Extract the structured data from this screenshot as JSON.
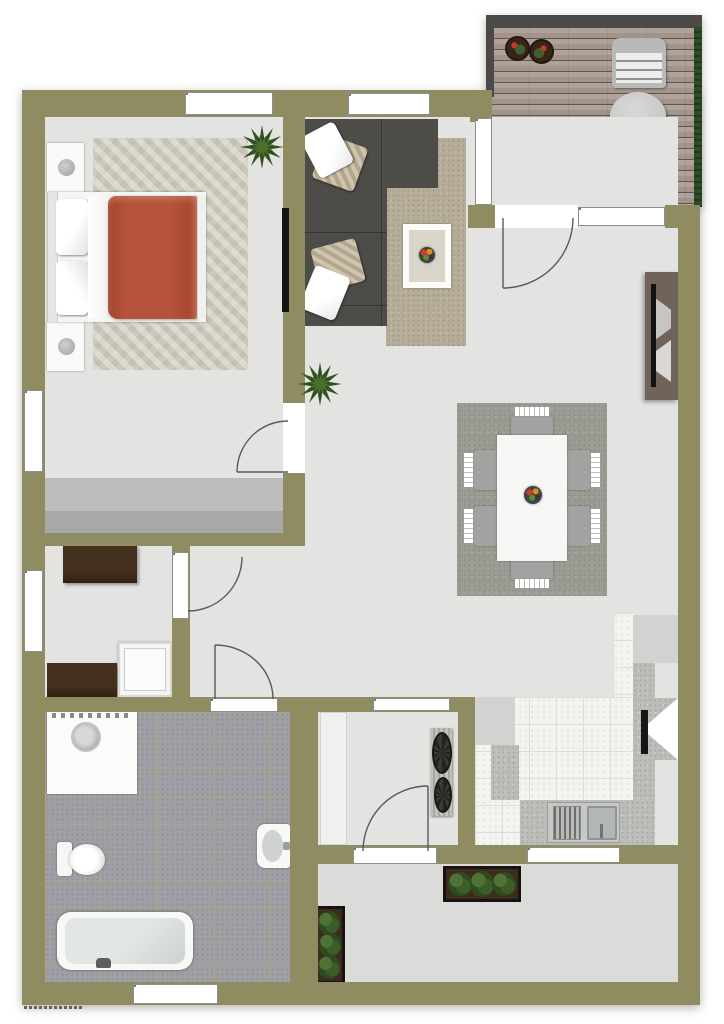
{
  "plan": {
    "type": "apartment-floor-plan-top-view",
    "colors": {
      "wall": "#8e8c60",
      "wallDark": "#4b4a47",
      "floor": "#e3e3e1",
      "terrace": "#dbdbd9",
      "closet": "#a8a8a8",
      "wood1": "#b0a298",
      "wood2": "#a2948a",
      "woodSeam": "#5f564e",
      "hedge": "#2c4d28",
      "tileBath": "#9fa0a6",
      "groutBath": "#b0a284",
      "tileKitchen": "#f3f3f0",
      "counter": "#bcbcb8",
      "cabinet": "#d2d2d0",
      "rugBeige": "#b5ad9a",
      "rugBedroom": "#ccc8bb",
      "rugDining": "#9b9b93",
      "sofa": "#4d4c49",
      "blanket": "#b5523a",
      "consoleBrown": "#6f635a",
      "planterSoil": "#3d2b1d"
    },
    "rooms": [
      {
        "name": "bedroom",
        "furniture": [
          "double-bed",
          "nightstand",
          "nightstand",
          "table-lamp",
          "table-lamp",
          "herringbone-rug",
          "wardrobe-closet",
          "wall-tv",
          "plant"
        ]
      },
      {
        "name": "living-room",
        "furniture": [
          "l-shaped-sectional-sofa",
          "throw-pillows",
          "area-rug",
          "coffee-table",
          "fruit-bowl",
          "plant",
          "tv-console",
          "wall-tv"
        ]
      },
      {
        "name": "dining-area",
        "furniture": [
          "dining-table",
          "dining-chair-x6",
          "area-rug",
          "fruit-bowl"
        ]
      },
      {
        "name": "kitchen",
        "furniture": [
          "countertop",
          "sink-unit",
          "corner-appliance",
          "upper-cabinets",
          "tiled-floor"
        ]
      },
      {
        "name": "hallway",
        "furniture": [
          "sideboard",
          "sideboard",
          "white-cabinet"
        ]
      },
      {
        "name": "bathroom",
        "furniture": [
          "washing-machine",
          "toilet",
          "wash-basin",
          "bathtub"
        ]
      },
      {
        "name": "storage-room",
        "furniture": [
          "built-in-closet",
          "wall-mounted-bicycle"
        ]
      },
      {
        "name": "balcony-deck",
        "furniture": [
          "round-table",
          "deck-chair",
          "deck-chair",
          "flower-pot",
          "flower-pot",
          "hedge-screen"
        ]
      },
      {
        "name": "terrace",
        "furniture": [
          "planter-box",
          "planter-box"
        ]
      }
    ],
    "openings": {
      "windows": 7,
      "hinged-doors": 5,
      "sliding-doors": 2
    },
    "counts": {
      "dining_chairs": 6,
      "deck_chairs": 2,
      "plants": 3,
      "planters": 2,
      "pillows": 4
    }
  }
}
